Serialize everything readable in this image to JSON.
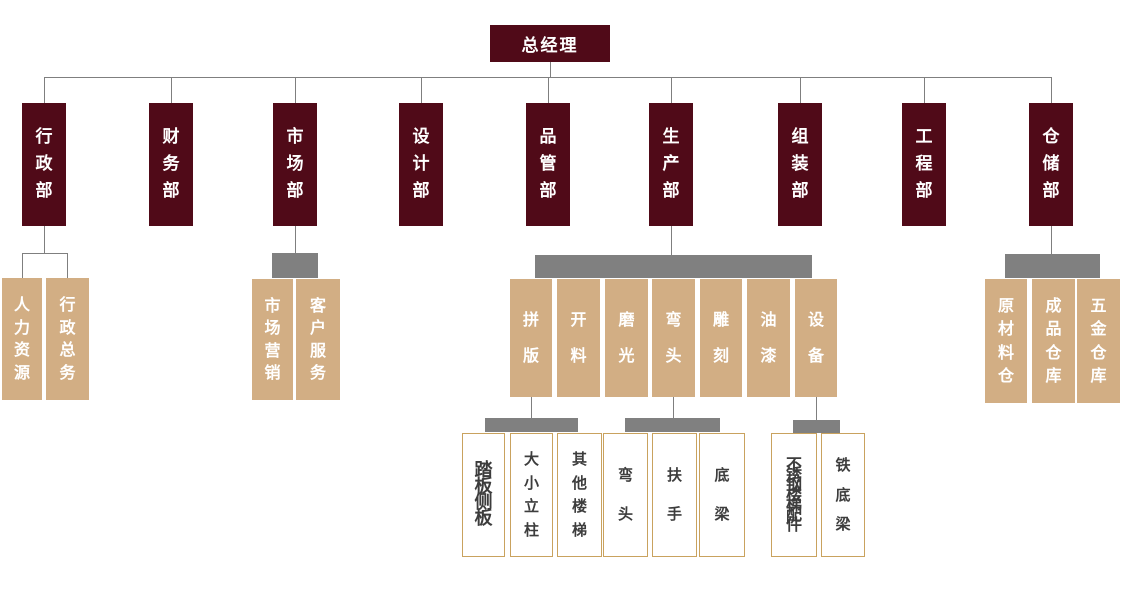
{
  "diagram_type": "org-chart",
  "colors": {
    "level1_level2_fill": "#500A18",
    "level3_fill": "#D2AE84",
    "junction_bar": "#808080",
    "connector_line": "#7F7F7F",
    "level4_border": "#C9A25E",
    "level4_text": "#3D3D3D",
    "level1_level2_level3_text": "#FFFFFF"
  },
  "org": {
    "label": "总经理",
    "children": [
      {
        "label": "行政部",
        "connector": "bracket",
        "children": [
          {
            "label": "人力资源"
          },
          {
            "label": "行政总务"
          }
        ]
      },
      {
        "label": "财务部"
      },
      {
        "label": "市场部",
        "connector": "bar",
        "children": [
          {
            "label": "市场营销"
          },
          {
            "label": "客户服务"
          }
        ]
      },
      {
        "label": "设计部"
      },
      {
        "label": "品管部"
      },
      {
        "label": "生产部",
        "connector": "bar",
        "children": [
          {
            "label": "拼版",
            "connector": "bar",
            "children": [
              {
                "label": "踏板侧板"
              },
              {
                "label": "大小立柱"
              },
              {
                "label": "其他楼梯"
              }
            ]
          },
          {
            "label": "开料"
          },
          {
            "label": "磨光"
          },
          {
            "label": "弯头",
            "connector": "bar",
            "children": [
              {
                "label": "弯头"
              },
              {
                "label": "扶手"
              },
              {
                "label": "底梁"
              }
            ]
          },
          {
            "label": "雕刻"
          },
          {
            "label": "油漆"
          },
          {
            "label": "设备",
            "connector": "bar",
            "children": [
              {
                "label": "不锈钢楼梯配件"
              },
              {
                "label": "铁底梁"
              }
            ]
          }
        ]
      },
      {
        "label": "组装部"
      },
      {
        "label": "工程部"
      },
      {
        "label": "仓储部",
        "connector": "bar",
        "children": [
          {
            "label": "原材料仓"
          },
          {
            "label": "成品仓库"
          },
          {
            "label": "五金仓库"
          }
        ]
      }
    ]
  }
}
